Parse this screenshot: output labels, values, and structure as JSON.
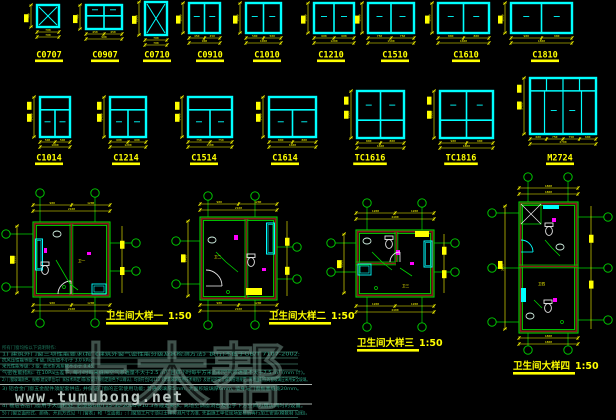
{
  "meta": {
    "title": "门窗大样及卫生间大样图",
    "background": "#000000"
  },
  "colors": {
    "window_cyan": "#00ffff",
    "dimension_yellow": "#ffff00",
    "axis_green": "#00d400",
    "wall_maroon": "#8b1a1a",
    "fixture_white": "#e8e8e8",
    "magenta": "#ff00ff",
    "note_green": "#2aa183",
    "watermark_gray": "#b9c6c1"
  },
  "window_schedule": {
    "row1": [
      {
        "label": "C0707",
        "width_mm": "700",
        "height_mm": "700",
        "segments": [
          "700"
        ]
      },
      {
        "label": "C0907",
        "width_mm": "900",
        "height_mm": "700",
        "segments": [
          "450",
          "450"
        ]
      },
      {
        "label": "C0710",
        "width_mm": "700",
        "height_mm": "1000",
        "segments": [
          "700"
        ]
      },
      {
        "label": "C0910",
        "width_mm": "900",
        "height_mm": "1000",
        "segments": [
          "450",
          "450"
        ]
      },
      {
        "label": "C1010",
        "width_mm": "1000",
        "height_mm": "1000",
        "segments": [
          "500",
          "500"
        ]
      },
      {
        "label": "C1210",
        "width_mm": "1200",
        "height_mm": "1000",
        "segments": [
          "600",
          "600"
        ]
      },
      {
        "label": "C1510",
        "width_mm": "1500",
        "height_mm": "1000",
        "segments": [
          "750",
          "750"
        ]
      },
      {
        "label": "C1610",
        "width_mm": "1600",
        "height_mm": "1000",
        "segments": [
          "800",
          "800"
        ]
      },
      {
        "label": "C1810",
        "width_mm": "1800",
        "height_mm": "1000",
        "segments": [
          "900",
          "900"
        ]
      }
    ],
    "row2": [
      {
        "label": "C1014",
        "width_mm": "1000",
        "height_mm": "1400",
        "segments": [
          "500",
          "500"
        ]
      },
      {
        "label": "C1214",
        "width_mm": "1200",
        "height_mm": "1400",
        "segments": [
          "600",
          "600"
        ]
      },
      {
        "label": "C1514",
        "width_mm": "1500",
        "height_mm": "1400",
        "segments": [
          "750",
          "750"
        ]
      },
      {
        "label": "C1614",
        "width_mm": "1600",
        "height_mm": "1400",
        "segments": [
          "800",
          "800"
        ]
      },
      {
        "label": "TC1616",
        "width_mm": "1600",
        "height_mm": "1600",
        "segments": [
          "800",
          "800"
        ]
      },
      {
        "label": "TC1816",
        "width_mm": "1800",
        "height_mm": "1600",
        "segments": [
          "900",
          "900"
        ]
      },
      {
        "label": "M2724",
        "width_mm": "2700",
        "height_mm": "2400",
        "segments": [
          "600",
          "750",
          "750",
          "600"
        ]
      }
    ]
  },
  "details": [
    {
      "label": "卫生间大样一",
      "scale": "1:50",
      "room_tag": "卫一",
      "dims": {
        "top": [
          "900",
          "1200"
        ],
        "top_total": "2100",
        "side": "2200",
        "bottom_total": "2100"
      }
    },
    {
      "label": "卫生间大样二",
      "scale": "1:50",
      "room_tag": "卫二",
      "dims": {
        "top": [
          "900",
          "1200"
        ],
        "top_total": "2100",
        "side": "2400",
        "bottom_total": "2100"
      }
    },
    {
      "label": "卫生间大样三",
      "scale": "1:50",
      "room_tag": "卫三",
      "dims": {
        "top": [
          "1200",
          "1200"
        ],
        "top_total": "2400",
        "side": "1800",
        "bottom_total": "2400"
      }
    },
    {
      "label": "卫生间大样四",
      "scale": "1:50",
      "room_tag": "卫四",
      "dims": {
        "top": [
          "1800"
        ],
        "top_total": "1800",
        "side": "3900",
        "bottom_total": "1800"
      }
    }
  ],
  "notes": {
    "lines": [
      "所有门窗均按以下说明制作:",
      "1) 建筑外门窗三项性能要求(按《建筑外窗气密性能分级及其检测方法》执行)不低于GB/T 7107-2002:",
      "抗风压性能等级: 4 级, 风压值不小于 3.0 kPa;",
      "采光性能等级: 3 级, 透光折减系数不小于 0.45;",
      "气密性能指标: 在10Pa压差下, 每小时每米缝隙空气渗透量不大于2.5 m³, 且每小时每平方米面积空气渗透量不大于7.5 m³ (mm 计)。",
      "2) 门窗玻璃颜色、规格(建设单位与厂家技术商定)或(按设计师指定颜色予以确认), 均须符合JGJ113《建筑玻璃应用技术规程》及建设部安全玻璃管理规定, 离地面较低的窗玻璃应采用安全玻璃。",
      "3) 铝合金门窗五金配件须配套供应, 并保证门窗的正常使用功能; 普通玻璃厚5mm, 大面积玻璃厚6mm, 墙身与门窗框塞缝宽20mm。",
      "4) 楼层各层门窗用于大面积处, 必须按GB/T15-30-2004中10.3条规定要求, 离地空调窗洞台及位于下方空间为厨房间时的设置。",
      "5) 门窗立面形式、颜色、开启方式见「门窗表」和「立面图」; 门窗加工尺寸须以土建实测尺寸为准, 先由施工单位现场复核后再行加工安装(模数制 见图)。"
    ]
  },
  "watermark": {
    "site_name": "土木帮",
    "site_url": "www.tumubong.net"
  }
}
